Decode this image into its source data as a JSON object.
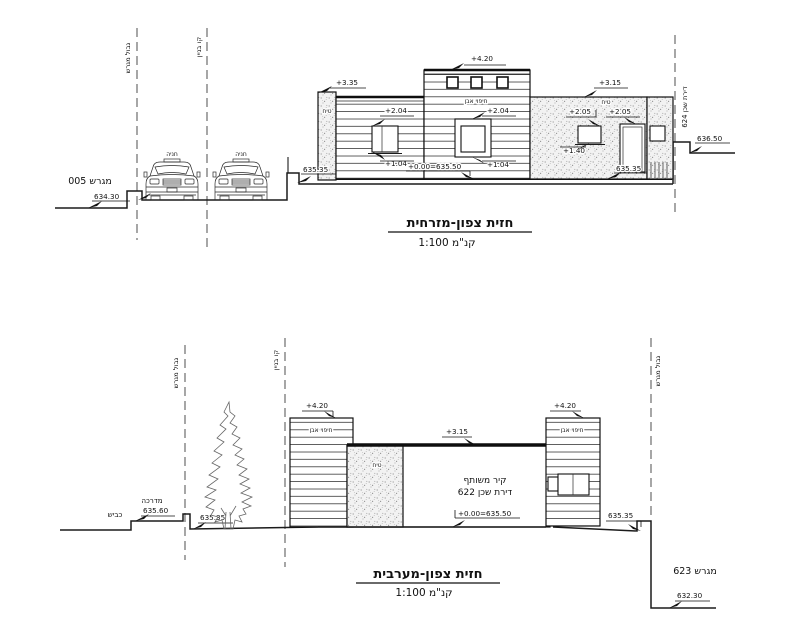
{
  "top": {
    "title": "חזית צפון-מזרחית",
    "scale": "קנ\"מ 1:100",
    "boundary_label": "גבול מגרש",
    "building_line_label": "קו בניין",
    "plot_label": "מגרש 005",
    "parking_1": "חניה",
    "parking_2": "חניה",
    "plaster_left": "טיח",
    "plaster_right": "טיח",
    "stone": "חיפוי אבן",
    "neighbor": "דירת שכן 624",
    "lv_road": "634.30",
    "lv_base_left": "635.35",
    "lv_base_right": "635.35",
    "lv_neighbor": "636.50",
    "lv_zero": "+0.00=635.50",
    "lv_335": "+3.35",
    "lv_420": "+4.20",
    "lv_315": "+3.15",
    "lv_204_a": "+2.04",
    "lv_104_a": "+1.04",
    "lv_204_b": "+2.04",
    "lv_104_b": "+1.04",
    "lv_205_a": "+2.05",
    "lv_140": "+1.40",
    "lv_205_b": "+2.05"
  },
  "bottom": {
    "title": "חזית צפון-מערבית",
    "scale": "קנ\"מ 1:100",
    "road": "כביש",
    "sidewalk": "מדרכה",
    "lv_sidewalk": "635.60",
    "lv_tree": "635.35",
    "boundary_left": "גבול מגרש",
    "building_line_label": "קו בניין",
    "boundary_right": "גבול מגרש",
    "lv_420_left": "+4.20",
    "lv_420_right": "+4.20",
    "lv_315": "+3.15",
    "stone_left": "חיפוי אבן",
    "stone_right": "חיפוי אבן",
    "plaster": "טיח",
    "shared_1": "קיר משותף",
    "shared_2": "דירת שכן 622",
    "lv_zero": "+0.00=635.50",
    "lv_base_right": "635.35",
    "plot_right": "מגרש 623",
    "lv_plot_right": "632.30"
  }
}
